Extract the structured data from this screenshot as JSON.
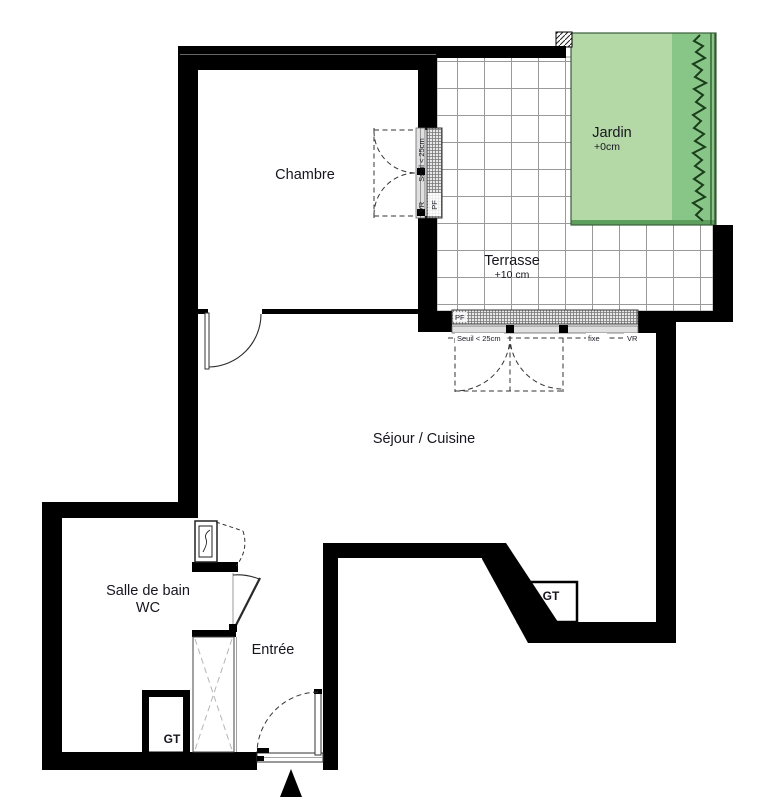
{
  "plan": {
    "rooms": {
      "chambre": {
        "label": "Chambre"
      },
      "terrasse": {
        "label": "Terrasse",
        "elevation": "+10 cm"
      },
      "jardin": {
        "label": "Jardin",
        "elevation": "+0cm"
      },
      "sejour_cuisine": {
        "label": "Séjour / Cuisine"
      },
      "salle_de_bain": {
        "line1": "Salle de bain",
        "line2": "WC"
      },
      "entree": {
        "label": "Entrée"
      },
      "gt_sejour": {
        "label": "GT"
      },
      "gt_salle_de_bain": {
        "label": "GT"
      }
    },
    "openings": {
      "terrace_window": {
        "pf": "PF",
        "seuil": "Seuil < 25cm",
        "fixe": "fixe",
        "vr": "VR"
      },
      "chambre_window": {
        "pf": "PF",
        "seuil": "Seuil < 25cm",
        "vr": "VR"
      }
    },
    "colors": {
      "wall": "#000000",
      "jardin_light": "#b5d8a7",
      "jardin_dark": "#87c687",
      "jardin_border": "#3a5f3a",
      "hedge": "#1c3d1c",
      "tile_line": "#9a9a9a",
      "text": "#161620"
    }
  }
}
